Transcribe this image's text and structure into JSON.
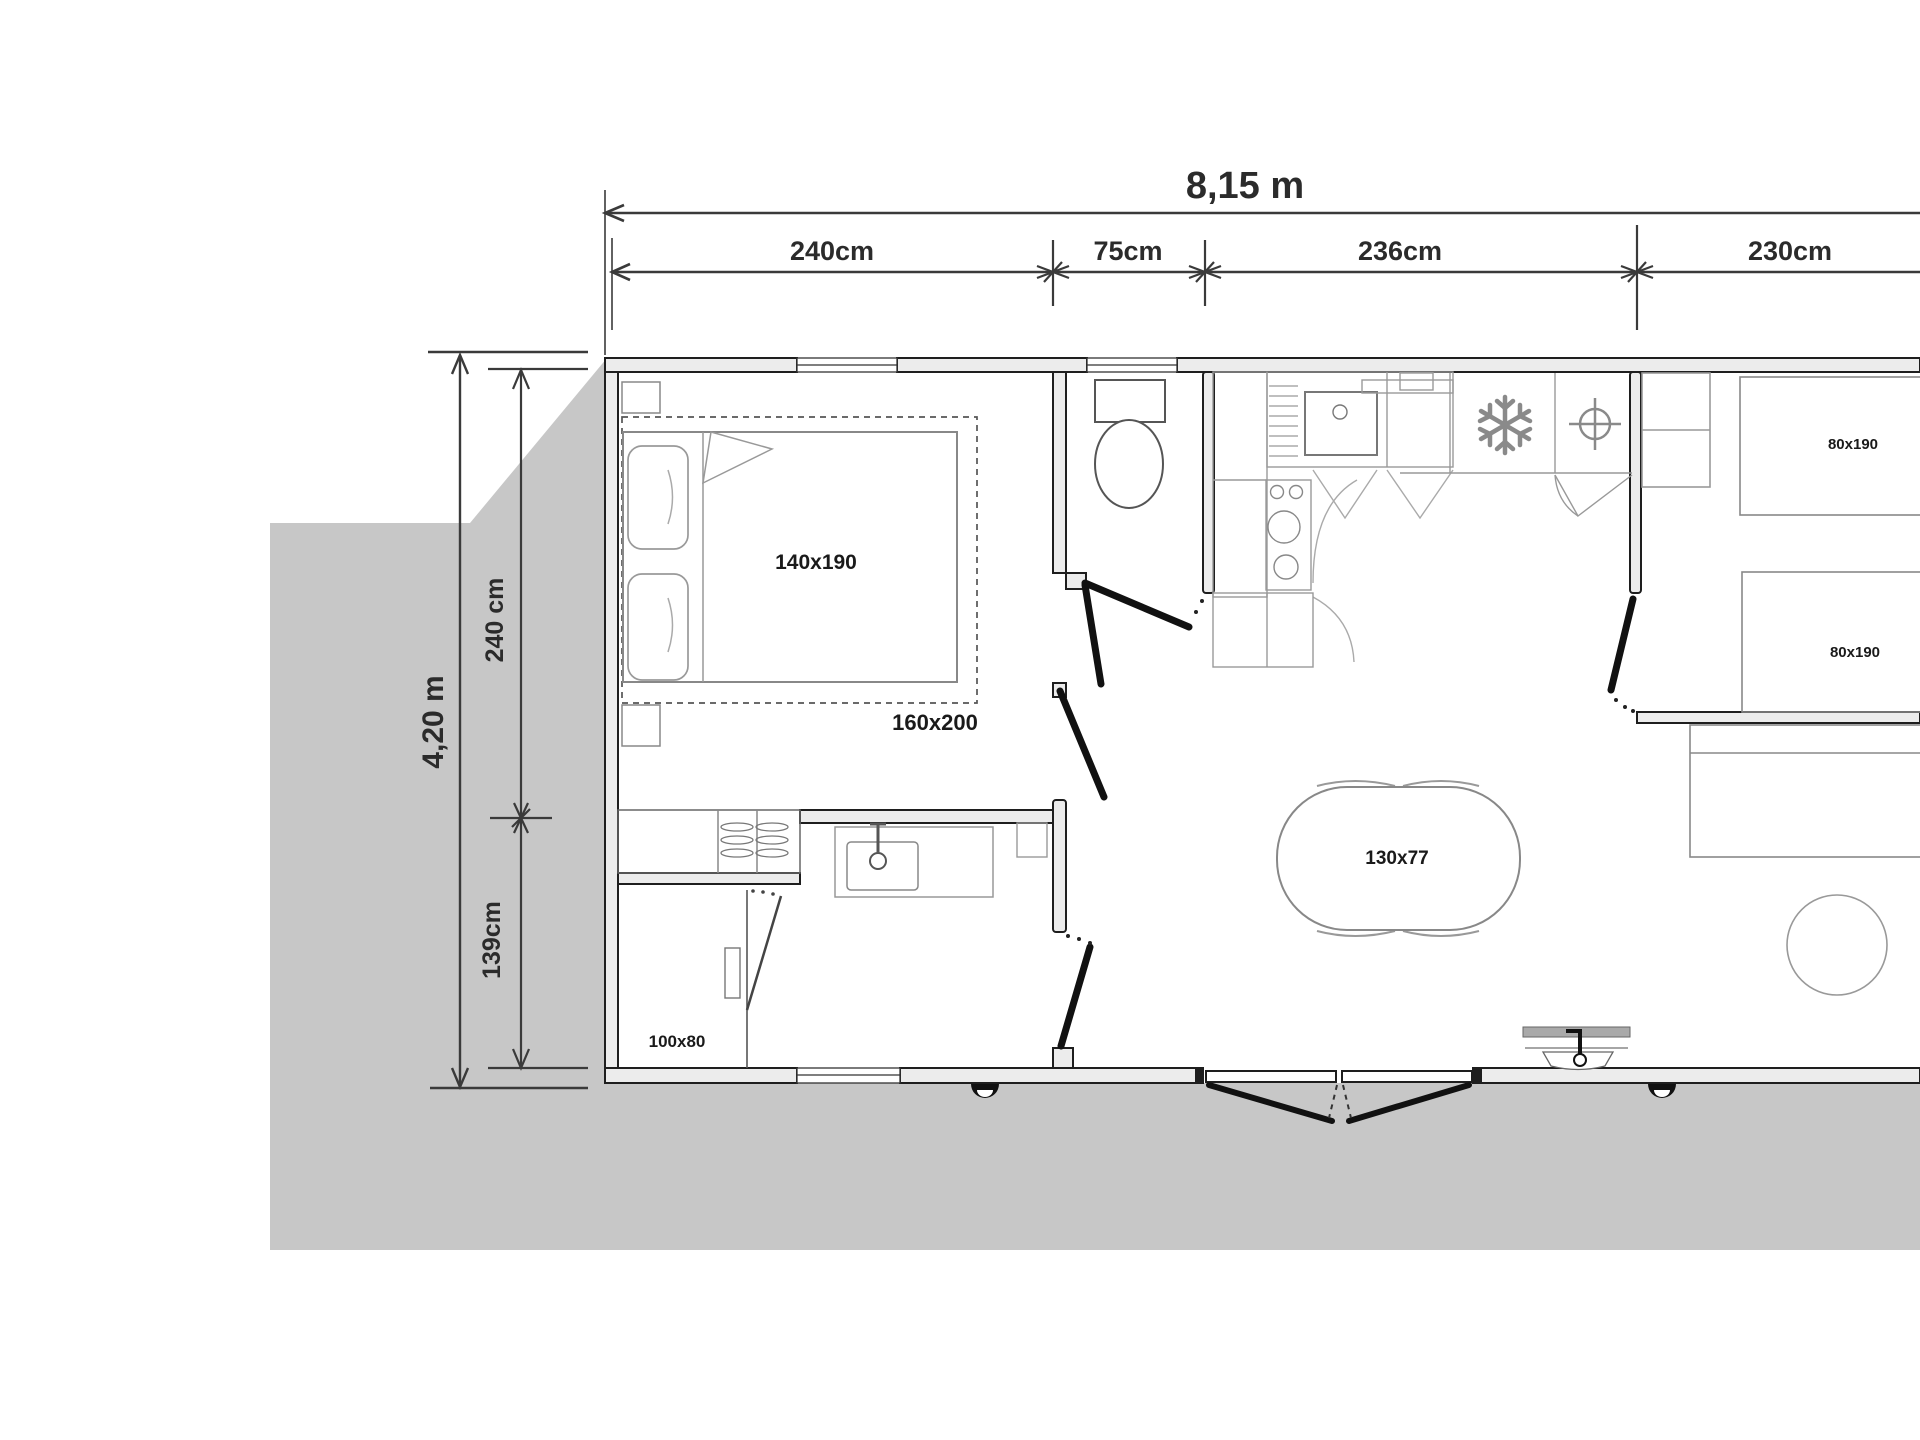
{
  "plan": {
    "overall_width_label": "8,15 m",
    "overall_depth_label": "4,20 m",
    "top_segment_labels": [
      "240cm",
      "75cm",
      "236cm",
      "230cm"
    ],
    "left_segment_labels": [
      "240 cm",
      "139cm"
    ],
    "furniture_labels": {
      "master_bed": "140x190",
      "master_bed_zone": "160x200",
      "shower_tray": "100x80",
      "dining_table": "130x77",
      "twin_bed_1": "80x190",
      "twin_bed_2": "80x190"
    },
    "colors": {
      "ground_shadow": "#c7c7c7",
      "wall_fill": "#ececec",
      "wall_stroke": "#1e1e1e",
      "furniture_stroke": "#8a8a8a",
      "fixture_stroke": "#555555",
      "dimension_color": "#3a3a3a",
      "door_leaf": "#111111"
    }
  }
}
